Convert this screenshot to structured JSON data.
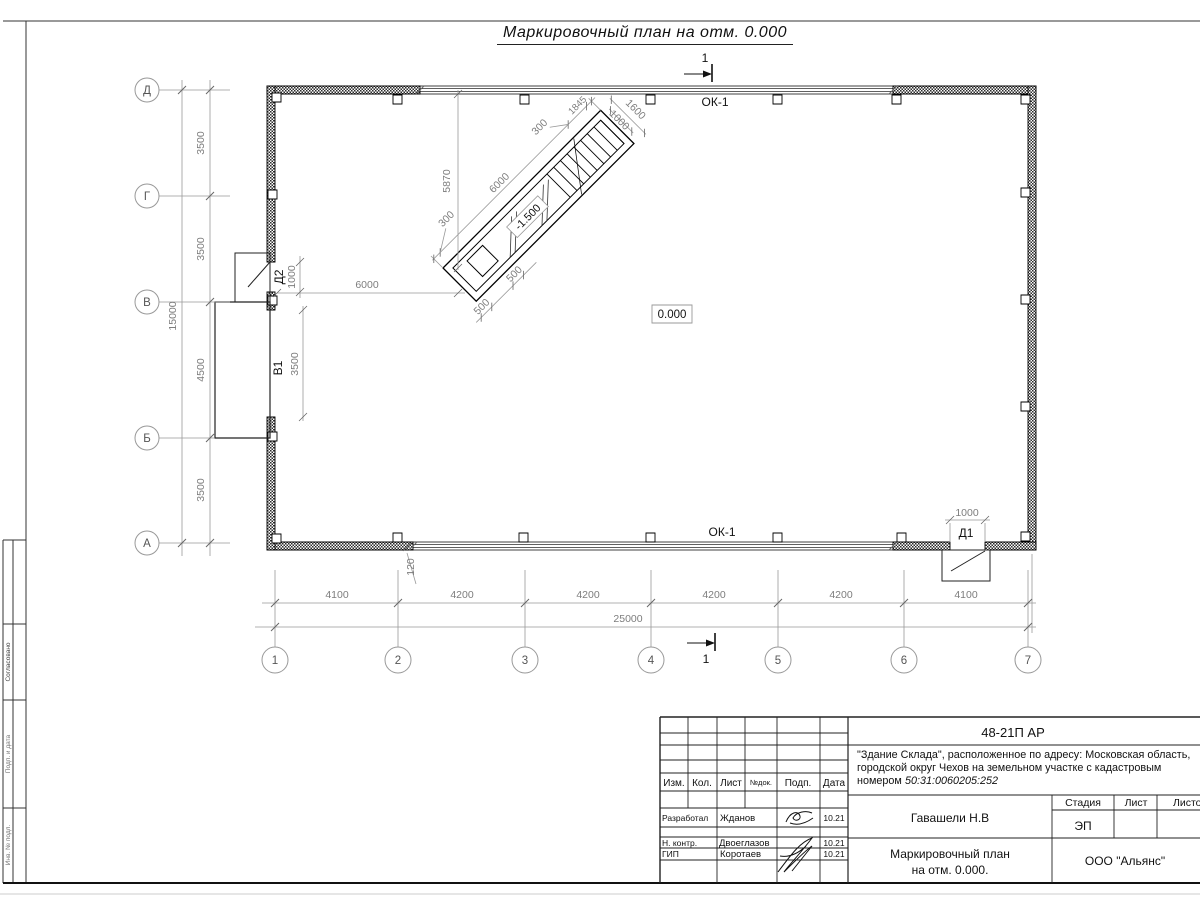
{
  "title": "Маркировочный план на отм. 0.000",
  "labels": {
    "ok1_top": "ОК-1",
    "ok1_bottom": "ОК-1",
    "d1": "Д1",
    "d2": "Д2",
    "v1": "В1",
    "elev_main": "0.000",
    "elev_ramp": "-1.500",
    "section_top": "1",
    "section_bottom": "1"
  },
  "axes": {
    "vertical": [
      "Д",
      "Г",
      "В",
      "Б",
      "А"
    ],
    "horizontal": [
      "1",
      "2",
      "3",
      "4",
      "5",
      "6",
      "7"
    ]
  },
  "dims": {
    "left_total": "15000",
    "left_chain": [
      "3500",
      "3500",
      "4500",
      "3500"
    ],
    "bottom_total": "25000",
    "bottom_chain": [
      "4100",
      "4200",
      "4200",
      "4200",
      "4200",
      "4100"
    ],
    "ramp_from_wall": "5870",
    "ramp_from_left_wall": "6000",
    "ramp_length": "6000",
    "ramp_end_bottom": "300",
    "ramp_end_top": "300",
    "ramp_stair_len": "1845",
    "ramp_width_outer": "1600",
    "ramp_width_inner": "1000",
    "ramp_side_a": "500",
    "ramp_side_b": "500",
    "wall_step": "120",
    "d1_width": "1000",
    "d2_width": "1000",
    "v1_width": "3500"
  },
  "titleblock": {
    "doc_code": "48-21П АР",
    "project_line1": "\"Здание Склада\", расположенное по адресу: Московская область,",
    "project_line2": "городской округ Чехов на земельном участке с кадастровым",
    "project_line3a": "номером ",
    "project_line3b": "50:31:0060205:252",
    "col_izm": "Изм.",
    "col_kol": "Кол.",
    "col_list": "Лист",
    "col_ndok": "№док.",
    "col_podp": "Подп.",
    "col_data": "Дата",
    "row1_role": "Разработал",
    "row1_name": "Жданов",
    "row1_date": "10.21",
    "row2_role": "Н. контр.",
    "row2_name": "Двоеглазов",
    "row2_date": "10.21",
    "row3_role": "ГИП",
    "row3_name": "Коротаев",
    "row3_date": "10.21",
    "chief": "Гавашели Н.В",
    "stage_label": "Стадия",
    "list_label": "Лист",
    "listov_label": "Листов",
    "stage": "ЭП",
    "doc_name1": "Маркировочный план",
    "doc_name2": "на отм. 0.000.",
    "company": "ООО \"Альянс\""
  },
  "frame": {
    "v1": "Согласовано",
    "v2": "Подп. и дата",
    "v3": "Инв. № подл."
  }
}
